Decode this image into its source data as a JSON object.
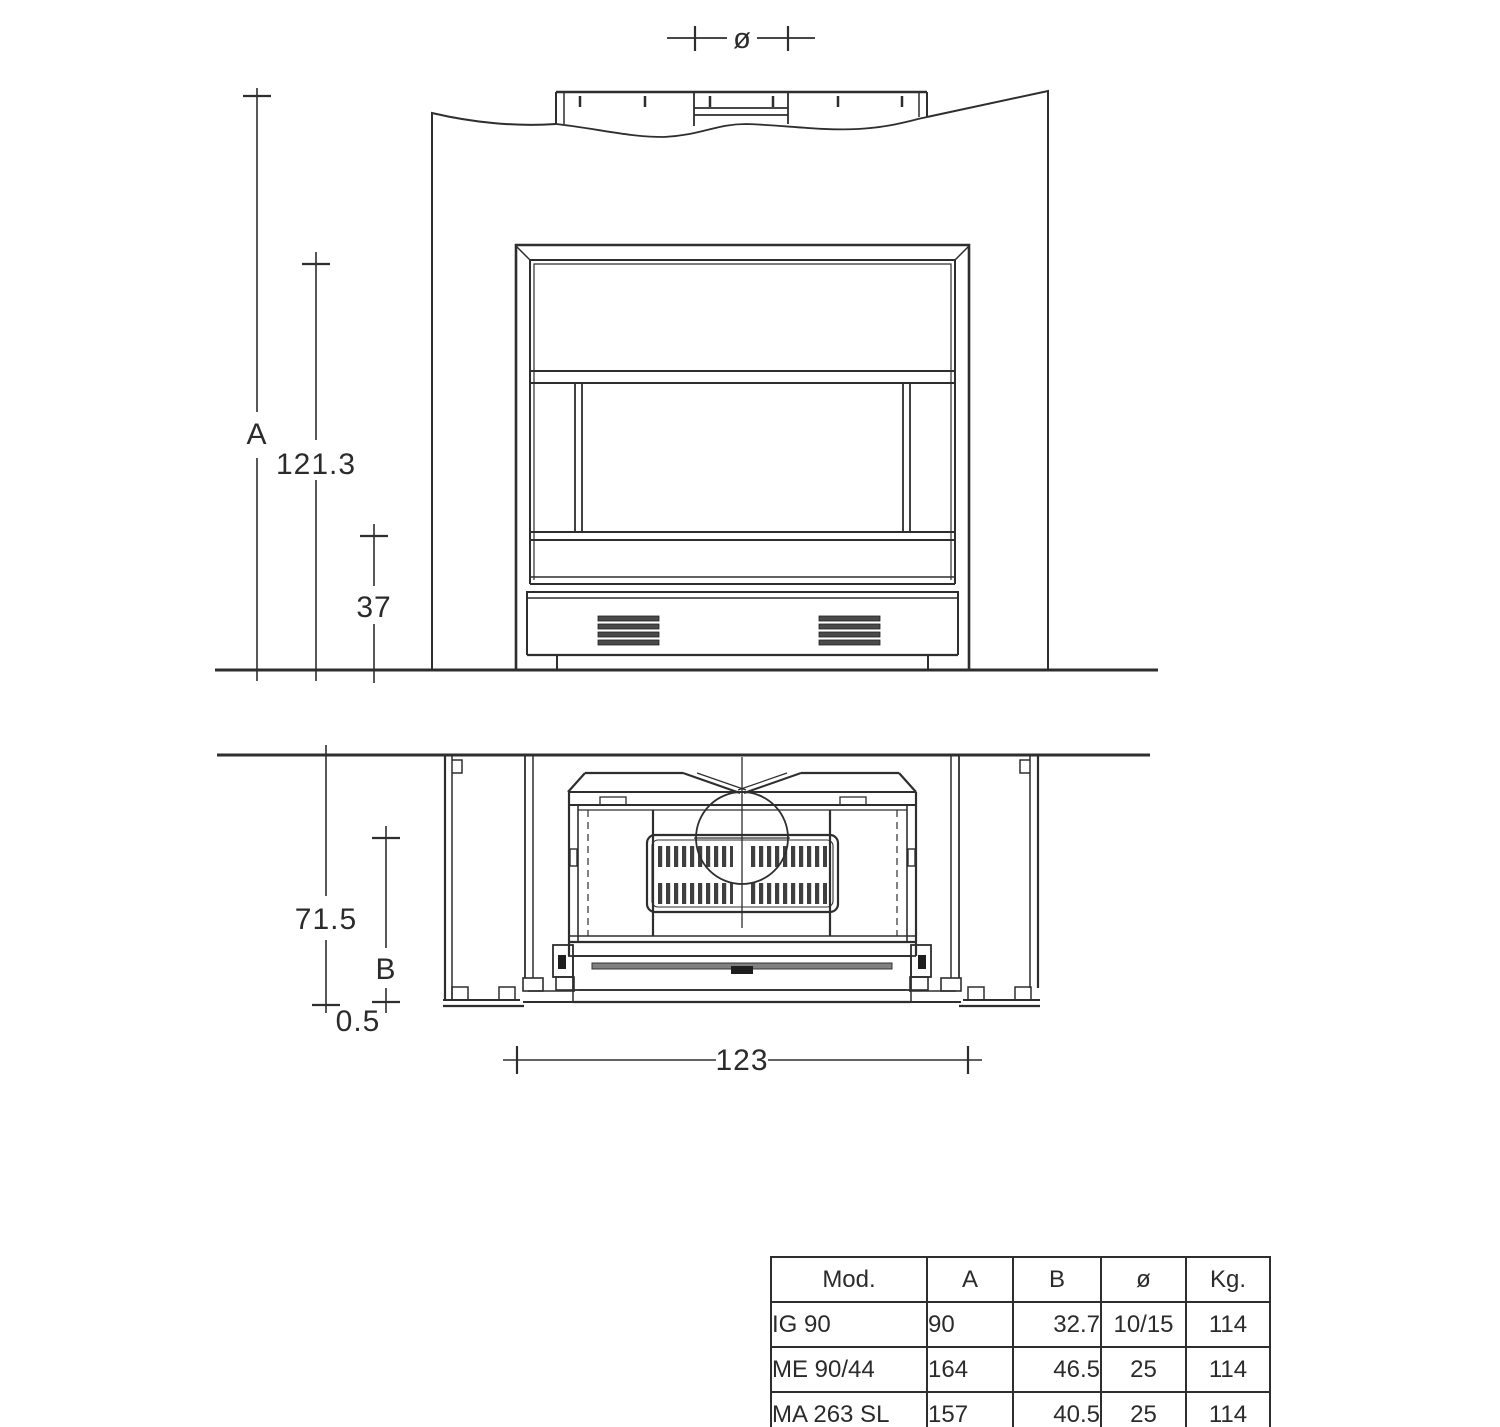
{
  "drawing": {
    "front_view": {
      "dim_a_label": "A",
      "dim_height_label": "121.3",
      "dim_plinth_label": "37",
      "dim_flue_label": "ø"
    },
    "plan_view": {
      "dim_depth_label": "71.5",
      "dim_b_label": "B",
      "dim_offset_label": "0.5",
      "dim_width_label": "123"
    }
  },
  "table": {
    "headers": [
      "Mod.",
      "A",
      "B",
      "ø",
      "Kg."
    ],
    "rows": [
      [
        "IG 90",
        "90",
        "32.7",
        "10/15",
        "114"
      ],
      [
        "ME 90/44",
        "164",
        "46.5",
        "25",
        "114"
      ],
      [
        "MA 263 SL",
        "157",
        "40.5",
        "25",
        "114"
      ]
    ]
  }
}
